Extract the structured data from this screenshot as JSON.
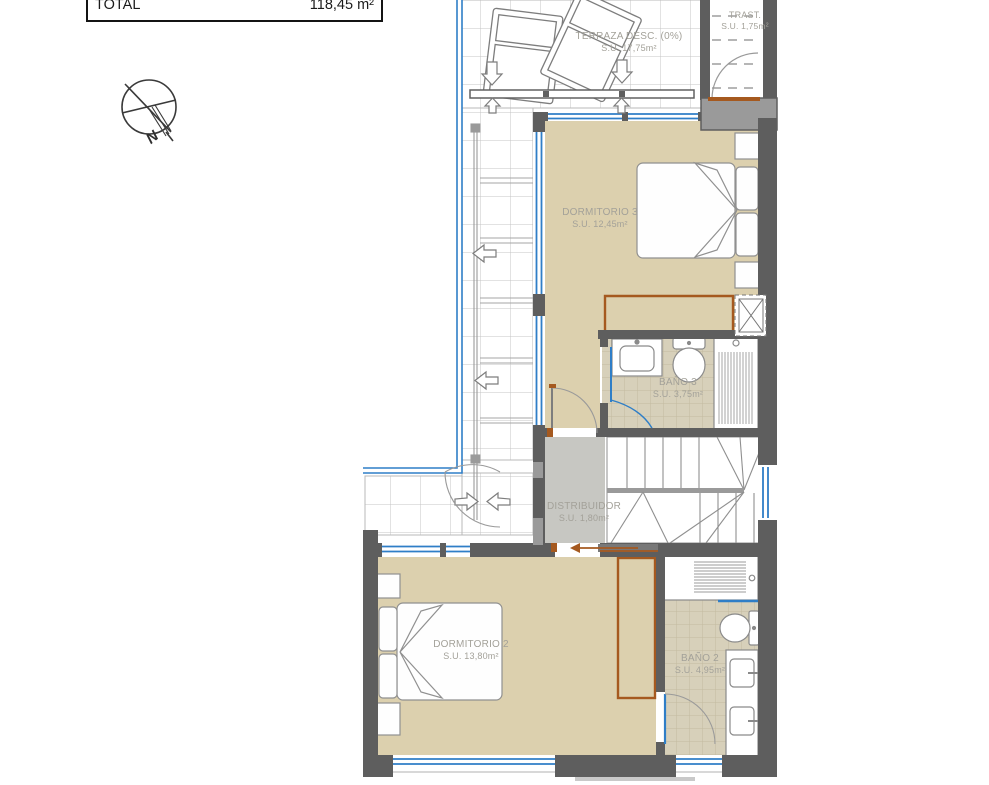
{
  "legend": {
    "label": "TOTAL",
    "value": "118,45 m²"
  },
  "compass": {
    "north": "N"
  },
  "rooms": {
    "terraza": {
      "name": "TERRAZA DESC. (0%)",
      "area": "S.U. 17,75m²"
    },
    "trastero": {
      "name": "TRAST.",
      "area": "S.U. 1,75m²"
    },
    "dormitorio3": {
      "name": "DORMITORIO 3",
      "area": "S.U. 12,45m²"
    },
    "bano3": {
      "name": "BAÑO 3",
      "area": "S.U. 3,75m²"
    },
    "distribuidor": {
      "name": "DISTRIBUIDOR",
      "area": "S.U. 1,80m²"
    },
    "dormitorio2": {
      "name": "DORMITORIO 2",
      "area": "S.U. 13,80m²"
    },
    "bano2": {
      "name": "BAÑO 2",
      "area": "S.U. 4,95m²"
    }
  },
  "colors": {
    "wall": "#5e5e5e",
    "wall_light": "#9a9a9a",
    "floor_wood": "#dcd0ae",
    "floor_bath": "#d7d0ba",
    "floor_hall": "#c7c7c2",
    "window_blue": "#2f7ec7",
    "door_brown": "#a5591f",
    "label_grey": "#a3a199"
  }
}
